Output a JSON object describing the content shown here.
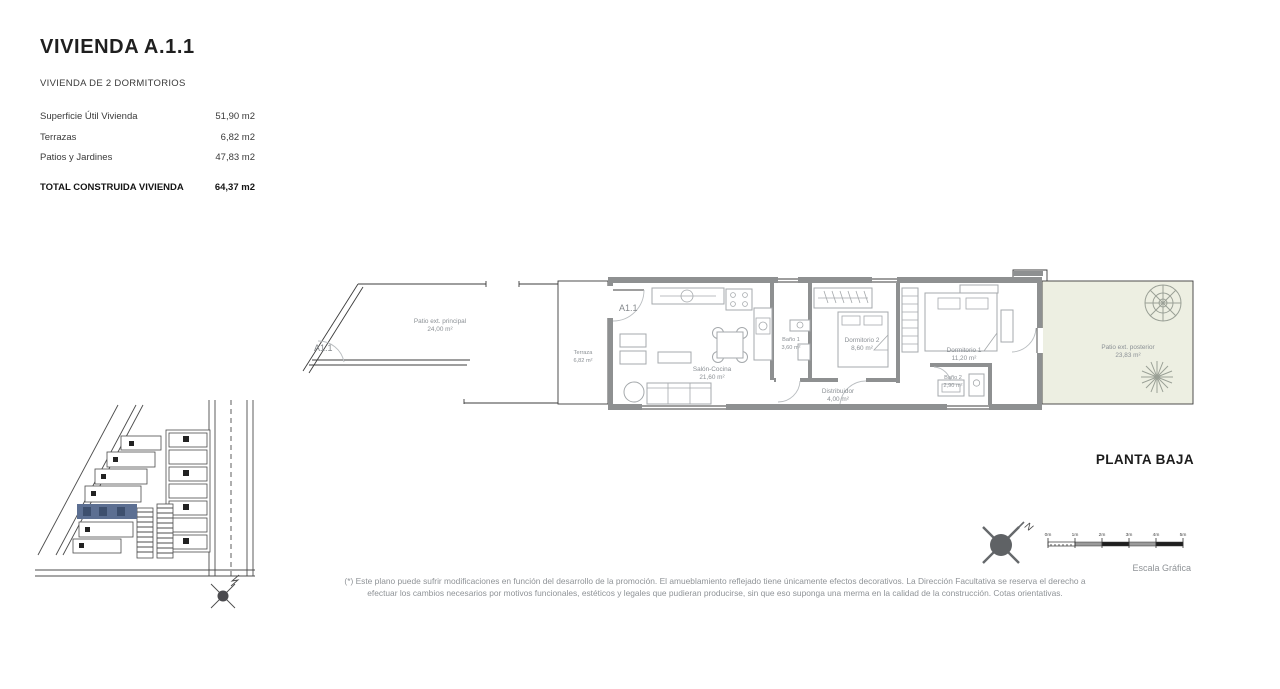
{
  "page": {
    "planta": "PLANTA BAJA"
  },
  "info_panel": {
    "title": "VIVIENDA A.1.1",
    "subtitle": "VIVIENDA DE 2 DORMITORIOS",
    "rows": [
      {
        "label": "Superficie Útil Vivienda",
        "value": "51,90 m2"
      },
      {
        "label": "Terrazas",
        "value": "6,82 m2"
      },
      {
        "label": "Patios y Jardines",
        "value": "47,83 m2"
      }
    ],
    "total": {
      "label": "TOTAL CONSTRUIDA VIVIENDA",
      "value": "64,37 m2"
    }
  },
  "floor_plan": {
    "entry_patio_label": "A1.1",
    "entry_unit_label": "A1.1",
    "rooms": [
      {
        "name": "Patio ext. principal",
        "area": "24,00 m²"
      },
      {
        "name": "Terraza",
        "area": "6,82 m²"
      },
      {
        "name": "Salón-Cocina",
        "area": "21,60 m²"
      },
      {
        "name": "Baño 1",
        "area": "3,60 m²"
      },
      {
        "name": "Dormitorio 2",
        "area": "8,60 m²"
      },
      {
        "name": "Distribuidor",
        "area": "4,00 m²"
      },
      {
        "name": "Dormitorio 1",
        "area": "11,20 m²"
      },
      {
        "name": "Baño 2",
        "area": "2,90 m²"
      },
      {
        "name": "Patio ext. posterior",
        "area": "23,83 m²"
      }
    ]
  },
  "north": {
    "label": "N"
  },
  "scale_bar": {
    "ticks": [
      "0m",
      "1m",
      "2m",
      "3m",
      "4m",
      "5m"
    ],
    "caption": "Escala Gráfica"
  },
  "footnote": {
    "line1": "(*) Este plano puede sufrir modificaciones en función del desarrollo de la promoción. El amueblamiento reflejado tiene únicamente efectos decorativos. La Dirección Facultativa se reserva el derecho a",
    "line2": "efectuar los cambios necesarios por motivos funcionales, estéticos y legales que pudieran producirse, sin que eso suponga una merma en la calidad de la construcción. Cotas orientativas."
  },
  "colors": {
    "highlight_unit": "#5c6f92",
    "patio_posterior_fill": "#edefe2",
    "wall_gray": "#8e9091",
    "label_gray": "#8b9095"
  }
}
